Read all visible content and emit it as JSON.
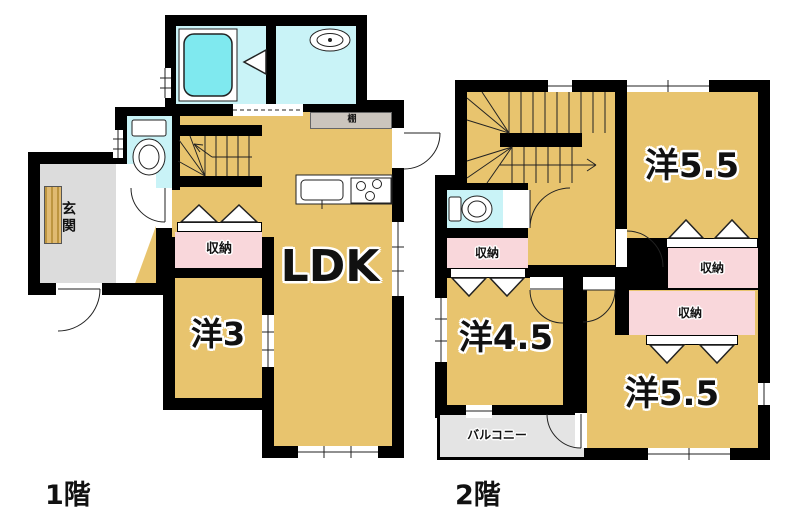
{
  "floor1": {
    "floor_label": "1階",
    "ldk": "LDK",
    "room3": "洋3",
    "closet": "収納",
    "entrance": "玄関",
    "shelf": "棚"
  },
  "floor2": {
    "floor_label": "2階",
    "room55_top": "洋5.5",
    "room55_bottom": "洋5.5",
    "room45": "洋4.5",
    "closet1": "収納",
    "closet2": "収納",
    "closet3": "収納",
    "balcony": "バルコニー"
  },
  "colors": {
    "wall": "#000000",
    "room_floor": "#E8C46E",
    "wet_area_floor": "#C9F3F7",
    "bathtub": "#7FE9EF",
    "closet_floor": "#F9D7DB",
    "entrance_floor": "#DCDCDC",
    "balcony_floor": "#E4E4E4",
    "shelf": "#CBC5BD"
  }
}
